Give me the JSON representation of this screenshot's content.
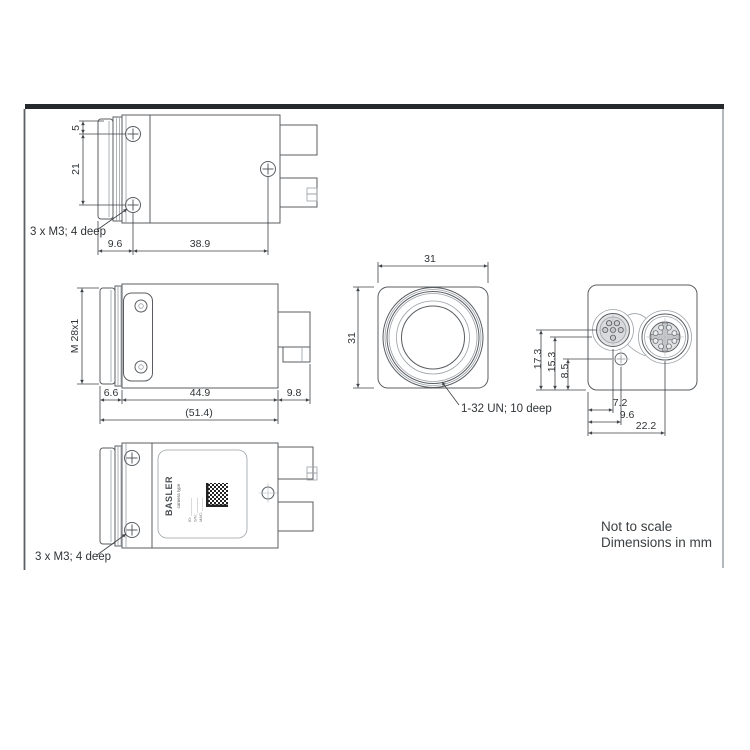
{
  "drawing": {
    "kind": "camera dimensional drawing",
    "footer": {
      "line1": "Not to scale",
      "line2": "Dimensions in mm"
    },
    "colors": {
      "line": "#595d61",
      "line_light": "#9aa0a5",
      "dimension": "#3f4347",
      "text": "#303437",
      "frame_bar": "#26292c",
      "connector_fill": "#e0e1e2",
      "label_code": "#222222",
      "background": "#ffffff"
    },
    "views": {
      "top": {
        "name": "side view (top)",
        "dim_5": "5",
        "dim_21": "21",
        "dim_9_6": "9.6",
        "dim_38_9": "38.9",
        "note": "3 x M3; 4 deep"
      },
      "middle": {
        "name": "side view (middle)",
        "thread": "M 28x1",
        "dim_6_6": "6.6",
        "dim_44_9": "44.9",
        "dim_51_4": "(51.4)",
        "dim_9_8": "9.8"
      },
      "bottom": {
        "name": "side view with label",
        "note": "3 x M3; 4 deep",
        "label": {
          "brand": "BASLER",
          "camera_type": "camera type",
          "id_line": "ID: ________",
          "sn_line": "S/N: _______",
          "mac_line": "MAC: ______"
        }
      },
      "front": {
        "name": "front view",
        "dim_width": "31",
        "dim_height": "31",
        "note": "1-32 UN; 10 deep"
      },
      "rear": {
        "name": "rear view",
        "dim_17_3": "17.3",
        "dim_15_3": "15.3",
        "dim_8_5": "8.5",
        "dim_7_2": "7.2",
        "dim_9_6": "9.6",
        "dim_22_2": "22.2"
      }
    }
  }
}
